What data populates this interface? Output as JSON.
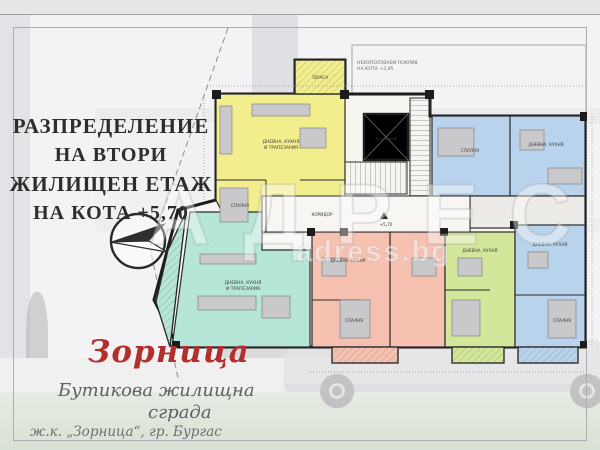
{
  "title": {
    "line1": "РАЗПРЕДЕЛЕНИЕ",
    "line2": "НА ВТОРИ",
    "line3": "ЖИЛИЩЕН ЕТАЖ",
    "line4": "НА КОТА +5,70"
  },
  "plan": {
    "roof_note_line1": "НЕИЗПОЛЗВАЕМ ПОКРИВ",
    "roof_note_line2": "НА КОТА +2,95",
    "labels": {
      "living_line1": "ДНЕВНА, КУХНЯ",
      "living_line2": "И ТРАПЕЗАРИЯ",
      "bedroom": "СПАЛНЯ",
      "terrace": "ТЕРАСА",
      "elevator": "АСАНСЬОР",
      "corridor": "КОРИДОР",
      "level": "+5,70"
    },
    "colors": {
      "yellow": "#f2ee8d",
      "blue": "#b9d3ec",
      "teal": "#b5e6d8",
      "salmon": "#f6c1b0",
      "green": "#d2e79a",
      "core": "#f6f5f2",
      "wall": "#1c1c1c"
    }
  },
  "watermark": {
    "text": "АДРЕС",
    "domain": "adress.bg"
  },
  "project": {
    "name": "Зорница",
    "type_line1": "Бутикова жилищна",
    "type_line2": "сграда",
    "location": "ж.к. „Зорница“, гр. Бургас",
    "name_color": "#b1302c"
  }
}
